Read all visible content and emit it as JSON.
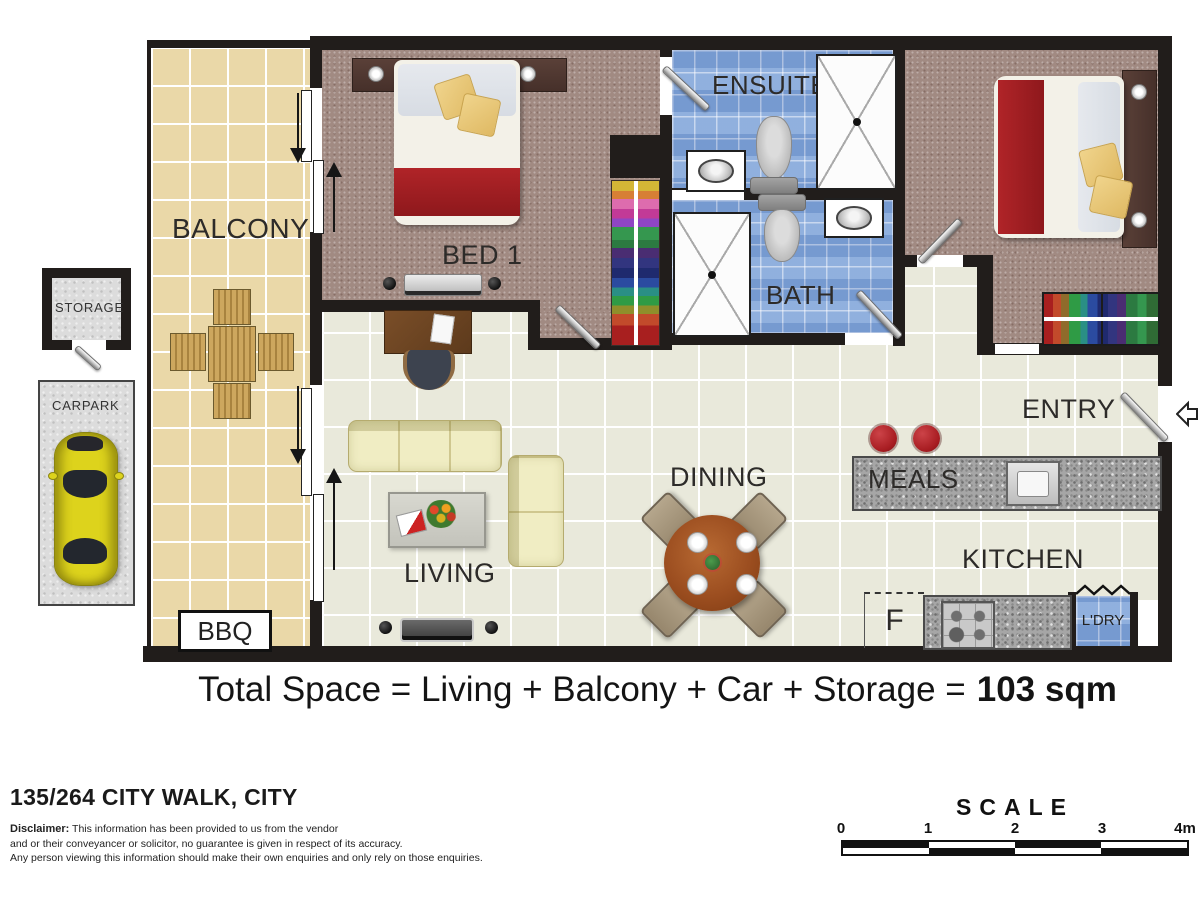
{
  "rooms": {
    "balcony": "BALCONY",
    "bed1": "BED 1",
    "ensuite": "ENSUITE",
    "bed2": "BED 2",
    "bath": "BATH",
    "entry": "ENTRY",
    "meals": "MEALS",
    "dining": "DINING",
    "kitchen": "KITCHEN",
    "living": "LIVING",
    "bbq": "BBQ",
    "fridge": "F",
    "laundry": "L'DRY",
    "storage": "STORAGE",
    "carpark": "CARPARK"
  },
  "total": {
    "prefix": "Total Space = Living + Balcony + Car + Storage =",
    "value": "103 sqm"
  },
  "address": "135/264 CITY WALK, CITY",
  "disclaimer": {
    "label": "Disclaimer:",
    "line1": "This information has been provided to us from the vendor",
    "line2": "and or their conveyancer or solicitor, no guarantee is given in respect of its accuracy.",
    "line3": "Any person viewing this information should make their own enquiries and only rely on those enquiries."
  },
  "scale": {
    "title": "SCALE",
    "ticks": [
      "0",
      "1",
      "2",
      "3",
      "4m"
    ]
  },
  "colors": {
    "wall": "#211d1b",
    "balcony_floor": "#ead8a8",
    "living_floor": "#e9e9db",
    "bedroom_carpet": "#a18a82",
    "bathroom_tile": "#84a7da",
    "granite_bench": "#a6a6a6",
    "stool_red": "#a81d22",
    "bed_blanket_red": "#a42025",
    "pillow_yellow": "#e9c878",
    "sofa_cream": "#f0edc3",
    "dining_table_wood": "#9c4e20",
    "car_yellow": "#ddd31c"
  }
}
